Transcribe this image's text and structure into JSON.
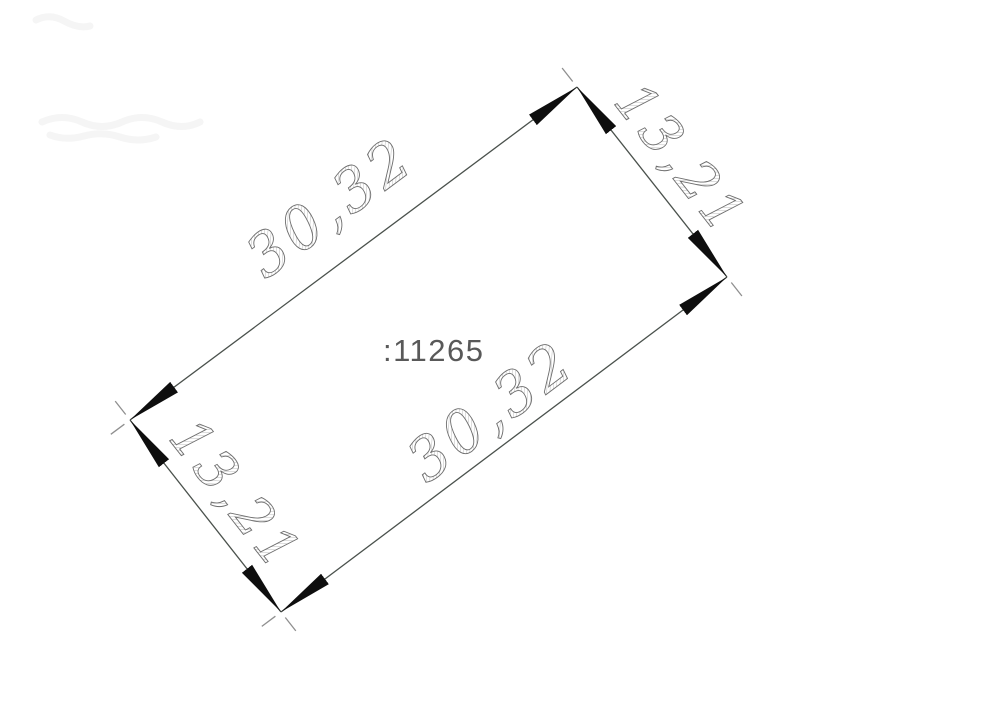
{
  "drawing": {
    "area_label": ":11265",
    "dimensions": [
      {
        "side": "top-left-long-side",
        "label": "30,32"
      },
      {
        "side": "top-right-short-side",
        "label": "13,21"
      },
      {
        "side": "bottom-right-long-side",
        "label": "30,32"
      },
      {
        "side": "bottom-left-short-side",
        "label": "13,21"
      }
    ],
    "colors": {
      "background": "#ffffff",
      "dimension_line": "#4a514c",
      "arrowhead": "#0e0e0e",
      "corner_tick": "#8f8f8f",
      "dimension_text_stroke": "#6e6e6e",
      "dimension_text_hatch": "#b5b5b5",
      "area_label": "#595959"
    }
  }
}
